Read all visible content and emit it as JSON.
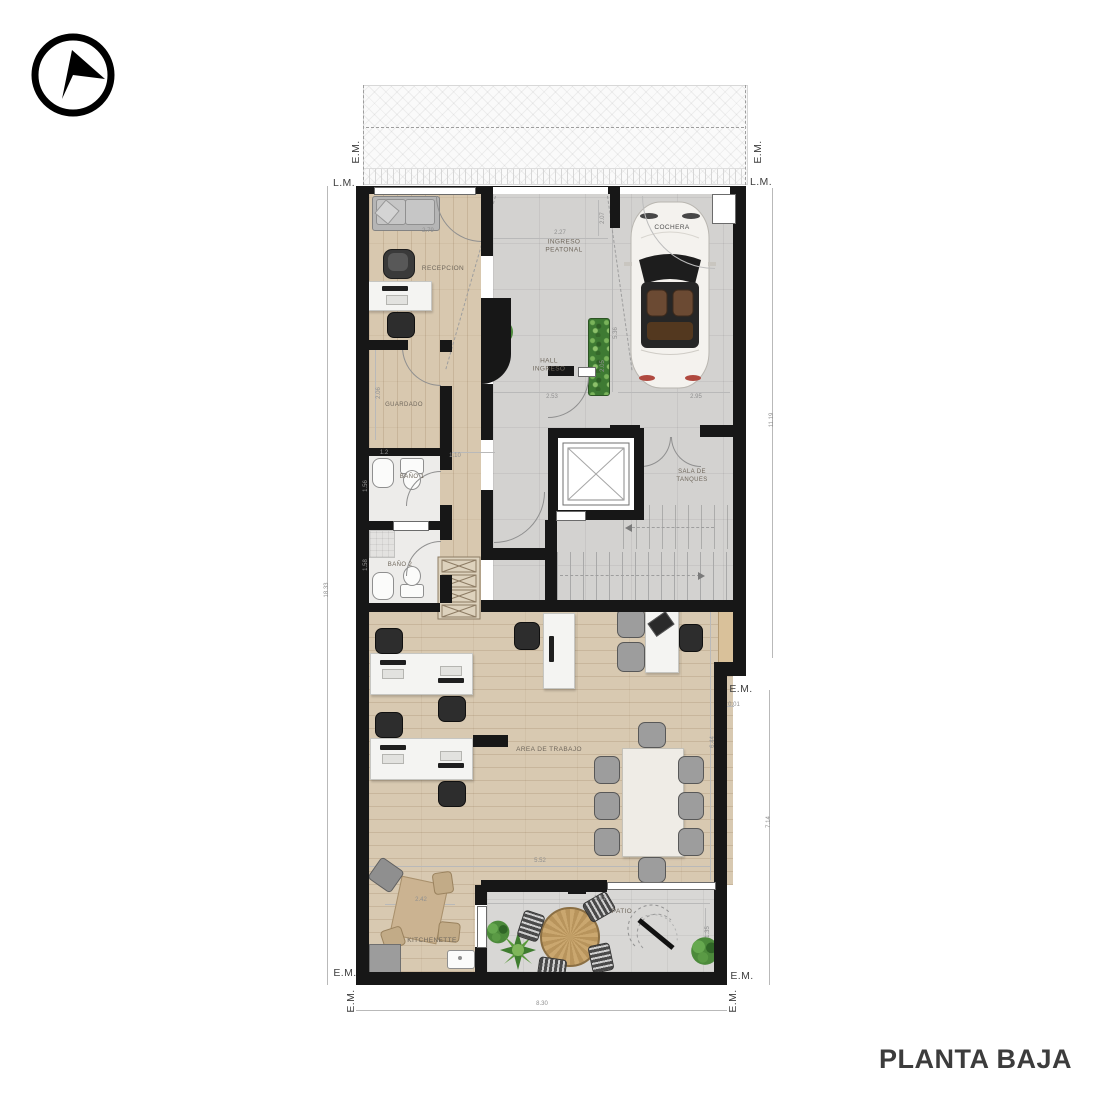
{
  "title": "PLANTA BAJA",
  "markers": {
    "em": "E.M.",
    "lm": "L.M."
  },
  "rooms": {
    "recepcion": "RECEPCION",
    "ingreso": "INGRESO\nPEATONAL",
    "hall": "HALL\nINGRESO",
    "cochera": "COCHERA",
    "guardado": "GUARDADO",
    "bano1": "BAÑO 1",
    "bano2": "BAÑO 2",
    "tanques": "SALA DE\nTANQUES",
    "trabajo": "AREA DE TRABAJO",
    "kitchenette": "KITCHENETTE",
    "patio": "PATIO"
  },
  "dims": {
    "lot_left": "18.33",
    "right_upper": "11.19",
    "right_lower": "7.14",
    "bottom": "8.30",
    "sofa": "2.79",
    "ingreso_w": "2.27",
    "ingreso_d": "2.07",
    "hall_w": "2.53",
    "hall_d": "2.05",
    "cochera_d": "5.36",
    "cochera_w": "2.95",
    "guardado_d": "2.06",
    "guardado_w": "1.2",
    "pasillo": "1.10",
    "bano1_d": "1.56",
    "bano2_d": "1.58",
    "notch": "0.01",
    "trabajo_d": "6.44",
    "trabajo_w": "5.52",
    "kitch_w": "2.42",
    "patio_w": "5.41",
    "patio_d": "1.35"
  }
}
